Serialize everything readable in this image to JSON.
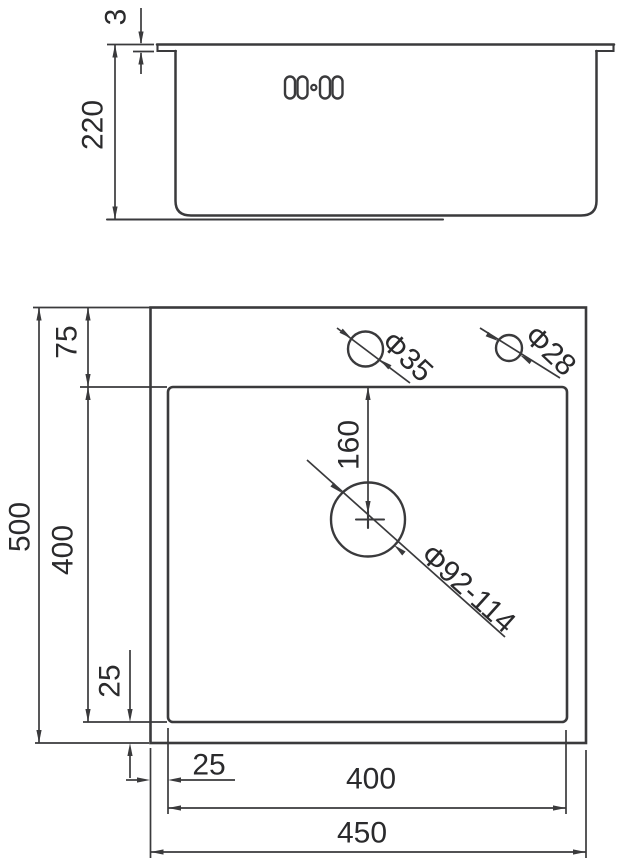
{
  "colors": {
    "line": "#3a3a3c",
    "text": "#2a2a2c",
    "background": "#ffffff"
  },
  "side_view": {
    "rim_thickness": "3",
    "bowl_depth": "220"
  },
  "plan_view": {
    "overall_height": "500",
    "ledge_offset": "75",
    "bowl_height": "400",
    "bowl_bottom_offset": "25",
    "bowl_left_offset": "25",
    "bowl_width": "400",
    "overall_width": "450",
    "drain_offset_from_bowl_top": "160",
    "faucet_hole_diameter": "Φ35",
    "accessory_hole_diameter": "Φ28",
    "drain_hole_diameter": "Φ92-114"
  }
}
